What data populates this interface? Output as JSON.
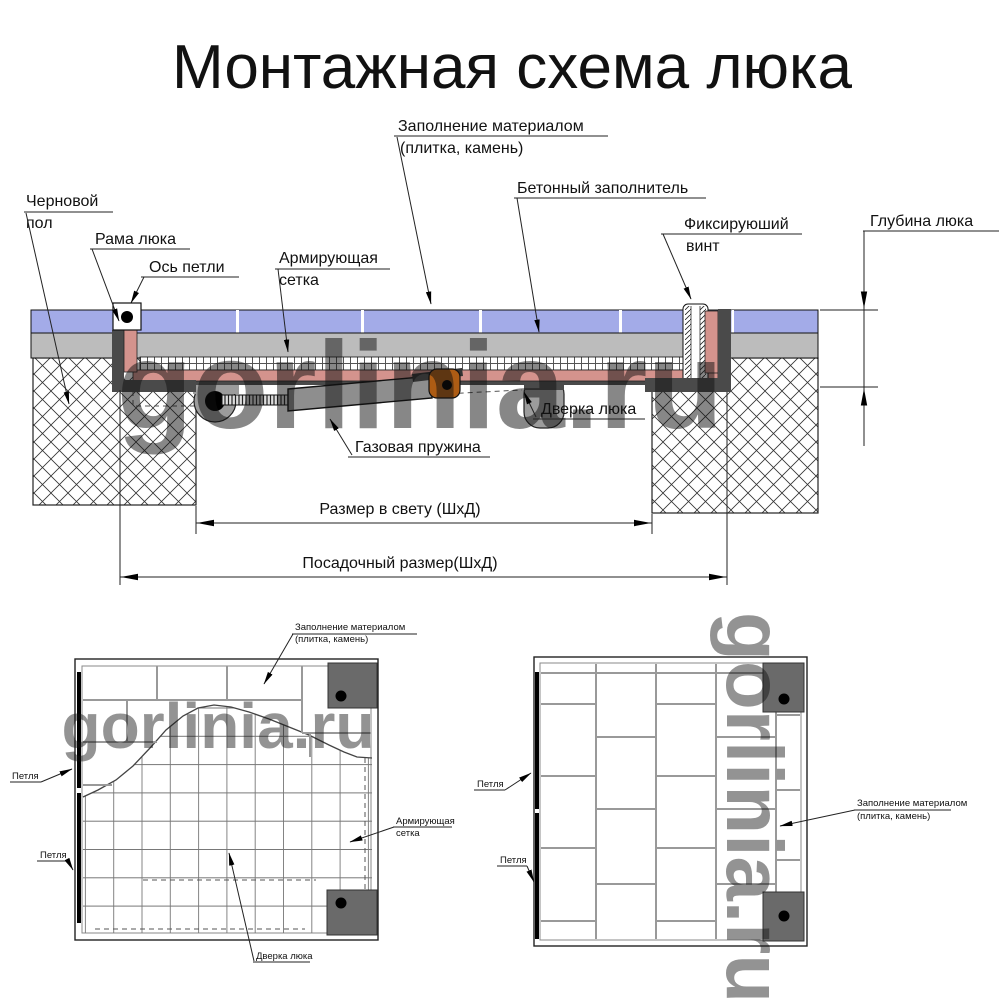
{
  "title": "Монтажная схема люка",
  "watermark": "gorlinia.ru",
  "colors": {
    "tile": "#a3abe8",
    "concrete": "#bcbcbc",
    "frame_pink": "#d4938d",
    "frame_dark": "#4a4a4a",
    "spring_gray": "#8e8e8e",
    "bracket_orange": "#ad5c14",
    "hinge_gray": "#9c9c9c",
    "plan_corner": "#6a6a6a",
    "watermark_gray": "#ababab"
  },
  "section_labels": {
    "fill_material_1": "Заполнение материалом",
    "fill_material_2": "(плитка, камень)",
    "concrete_filler": "Бетонный заполнитель",
    "fixing_screw_1": "Фиксируюший",
    "fixing_screw_2": "винт",
    "rough_floor_1": "Черновой",
    "rough_floor_2": "пол",
    "hatch_frame": "Рама люка",
    "hinge_axis": "Ось петли",
    "mesh_1": "Армирующая",
    "mesh_2": "сетка",
    "hatch_door": "Дверка люка",
    "gas_spring": "Газовая пружина"
  },
  "dimensions": {
    "depth": "Глубина люка",
    "clear_size": "Размер в свету (ШхД)",
    "mounting_size": "Посадочный размер(ШхД)"
  },
  "plan_left_labels": {
    "fill_material_1": "Заполнение материалом",
    "fill_material_2": "(плитка, камень)",
    "hinge": "Петля",
    "mesh_1": "Армирующая",
    "mesh_2": "сетка",
    "door": "Дверка люка"
  },
  "plan_right_labels": {
    "hinge": "Петля",
    "fill_material_1": "Заполнение материалом",
    "fill_material_2": "(плитка, камень)"
  }
}
